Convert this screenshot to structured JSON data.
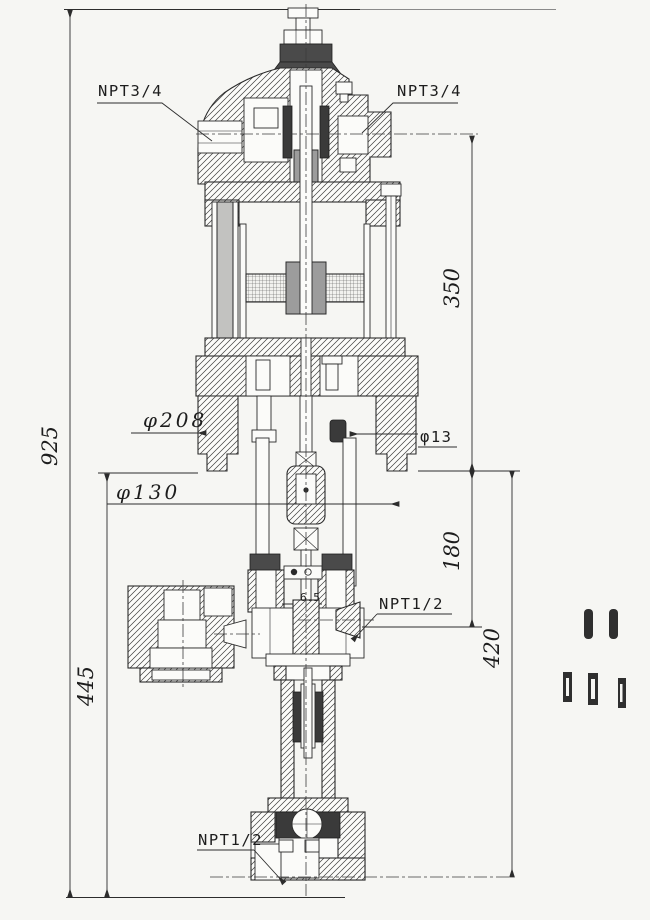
{
  "drawing": {
    "kind": "sectional-engineering-drawing",
    "ports": {
      "top_left": "NPT3/4",
      "top_right": "NPT3/4",
      "mid_right": "NPT1/2",
      "bottom": "NPT1/2"
    },
    "dims": {
      "overall": "925",
      "upper": "350",
      "mid": "180",
      "lower": "420",
      "left_lower": "445",
      "flange_dia": "φ208",
      "cyl_dia": "φ130",
      "hole_dia": "φ13",
      "finish": "6.5"
    },
    "colors": {
      "paper": "#f6f6f3",
      "ink": "#2b2b2b",
      "packing_dark": "#3a3a3a"
    }
  }
}
